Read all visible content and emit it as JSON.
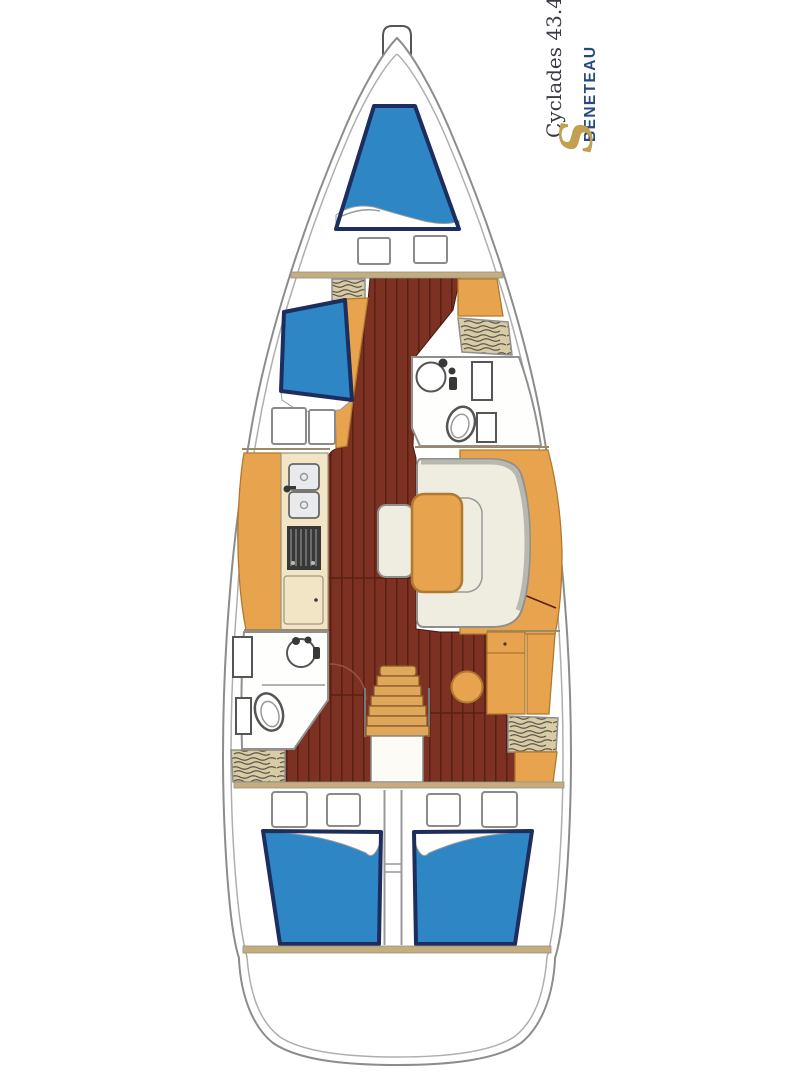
{
  "branding": {
    "model": "Cyclades 43.4",
    "brand": "BENETEAU",
    "logo_glyph": "S"
  },
  "colors": {
    "wood": "#7C3123",
    "wood-line": "#5A2013",
    "berth-blue": "#2E86C5",
    "berth-border": "#1C2D5E",
    "furniture-orange": "#E8A34F",
    "orange-line": "#B07A2E",
    "counter-cream": "#F1E5C6",
    "cream-line": "#A59B7F",
    "settee-cream": "#EFEDE0",
    "settee-line": "#8F8F8F",
    "settee-shadow": "#B9B8AF",
    "hatch-tan": "#D9CBA3",
    "hatch-line": "#55524A",
    "bulkhead-tan": "#C6AE7C",
    "hull-line": "#8C8C8C",
    "inner-line": "#AEAEAE",
    "room-line": "#909090",
    "fixture-line": "#555555",
    "steel": "#E9EAEE",
    "stove-dark": "#383838",
    "step-tan": "#DFA75A",
    "step-line": "#8A5A28",
    "brand-navy": "#27497E",
    "brand-gold": "#C2A052",
    "text-dark": "#3B3B46"
  },
  "areas": [
    "anchor-locker",
    "forward-cabin-v-berth",
    "port-single-berth",
    "forward-head",
    "galley",
    "saloon-settee-and-table",
    "companionway-stairs",
    "aft-head",
    "nav-station",
    "aft-cabin-port",
    "aft-cabin-starboard",
    "stern-locker"
  ]
}
